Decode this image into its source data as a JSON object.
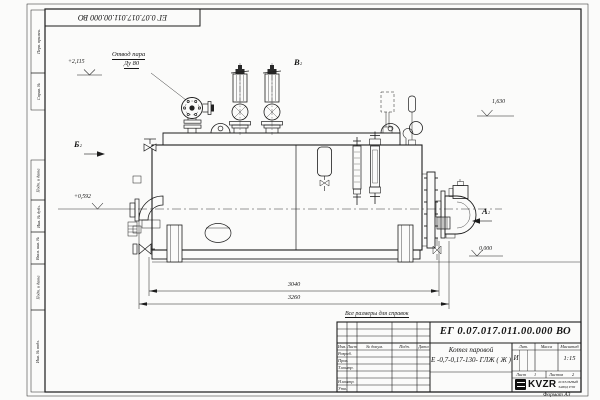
{
  "frame": {
    "stamp_rotated": "ЕГ 0.07.017.011.00.000 ВО",
    "format": "Формат А3",
    "margin_labels": [
      "Перв. примен.",
      "Справ. №",
      "Подп. и дата",
      "Инв. № дубл.",
      "Взам. инв. №",
      "Подп. и дата",
      "Инв. № подл."
    ]
  },
  "drawing": {
    "callout_line1": "Отвод пара",
    "callout_line2": "Ду 80",
    "view_a": "А",
    "view_b": "Б",
    "view_v": "В",
    "view_sub": "2",
    "elev_top": "+2,115",
    "elev_burner": "+0,592",
    "elev_right": "1,630",
    "elev_zero": "0,000",
    "dim_inner": "3040",
    "dim_outer": "3260"
  },
  "title_block": {
    "note": "Все размеры для справок",
    "doc_number": "ЕГ 0.07.017.011.00.000  ВО",
    "name1": "Котел паровой",
    "name2": "Е -0,7-0,17-130- ГЛЖ ( Ж )",
    "col_izm": "Изм.",
    "col_list": "Лист",
    "col_doc": "№ докум.",
    "col_podp": "Подп.",
    "col_data": "Дата",
    "row_razrab": "Разраб.",
    "row_prov": "Пров.",
    "row_tkontr": "Т.контр.",
    "row_nkontr": "Н.контр.",
    "row_utv": "Утв.",
    "lit": "Лит.",
    "lit_value": "И",
    "massa": "Масса",
    "masshtab": "Масштаб",
    "scale": "1:15",
    "list_label": "Лист",
    "list_value": "1",
    "listov_label": "Листов",
    "listov_value": "2",
    "logo_text": "KVZR",
    "logo_sub1": "КОТЕЛЬНЫЙ",
    "logo_sub2": "ЗАВОД РЭП"
  }
}
